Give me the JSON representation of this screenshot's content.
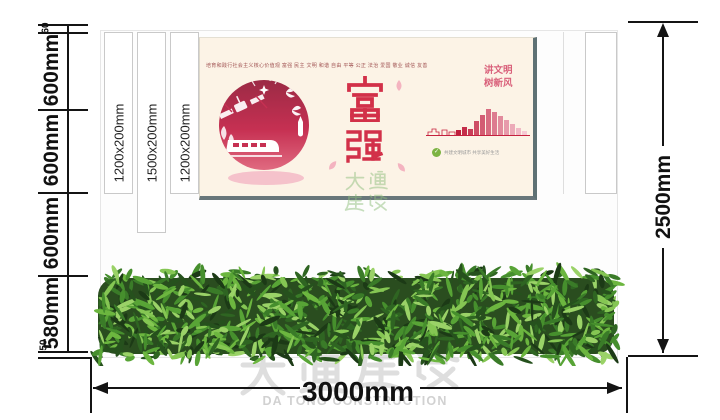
{
  "watermark": {
    "cn": "大通建设",
    "en": "DA TONG CONSTRUCTION"
  },
  "stamp": {
    "text": "大通建设"
  },
  "dims": {
    "top_offset": "60",
    "bottom_offset": "50",
    "seg1": "600mm",
    "seg2": "600mm",
    "seg3": "600mm",
    "seg4": "580mm",
    "total_height": "2500mm",
    "total_width": "3000mm"
  },
  "slats": {
    "s1": "1200x200mm",
    "s2": "1500x200mm",
    "s3": "1200x200mm"
  },
  "poster": {
    "headline": "培育和践行社会主义核心价值观  富强 民主 文明 和谐 自由 平等 公正 法治 爱国 敬业 诚信 友善",
    "slogan1": "讲文明",
    "slogan2": "树新风",
    "char1": "富",
    "char2": "强",
    "caption": "共建文明城市 共享美好生活",
    "skyline_heights": [
      5,
      8,
      6,
      14,
      20,
      26,
      23,
      19,
      15,
      11,
      7,
      4
    ],
    "colors": {
      "bg": "#fcf3e6",
      "red": "#d23049",
      "pink": "#f4b3c0",
      "green": "#7cb342"
    }
  }
}
